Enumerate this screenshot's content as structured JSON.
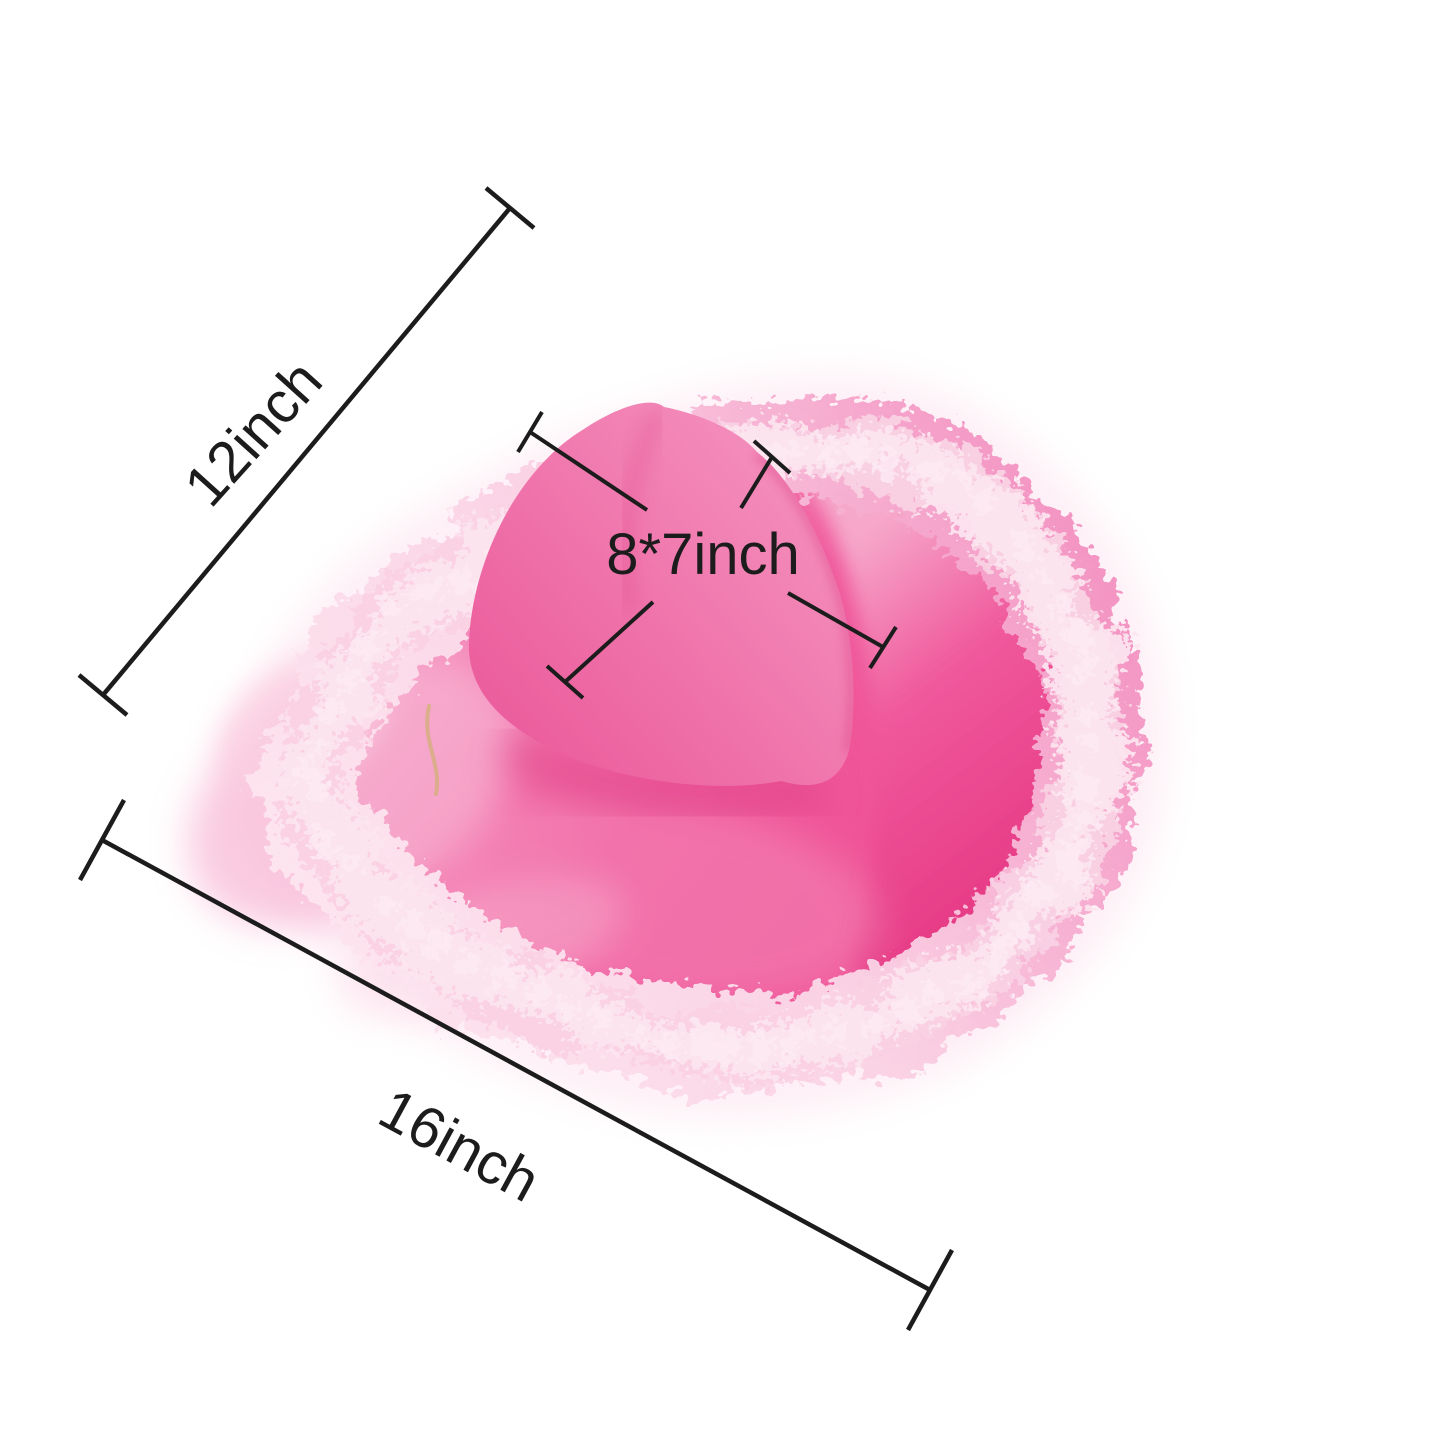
{
  "page": {
    "background": "#ffffff"
  },
  "subject": {
    "description": "pink cowboy hat with fluffy feather-trimmed brim, annotated with size measurements"
  },
  "annotations": {
    "color": "#1c1c1c",
    "brim_width": {
      "label": "12inch"
    },
    "brim_length": {
      "label": "16inch"
    },
    "crown_size": {
      "label": "8*7inch"
    }
  },
  "colors": {
    "background": "#ffffff",
    "felt_soft": "#f6a2c8",
    "felt_main": "#f0599c",
    "felt_bottom": "#ee4f93",
    "felt_deep": "#e73d87",
    "crown_light": "#f490bd",
    "crown_main": "#ec5f9e",
    "upturn_light": "#f6a8cb",
    "shadow_pink": "#dd3f85",
    "sheen_1": "#f8b6d4",
    "sheen_2": "#fbcfe1",
    "boa_pale": "#fde6f0",
    "boa_light": "#fad2e4",
    "boa_pink": "#f38fc0",
    "boa_halo": "#fdeaf3",
    "string_tan": "#d8ae85"
  }
}
